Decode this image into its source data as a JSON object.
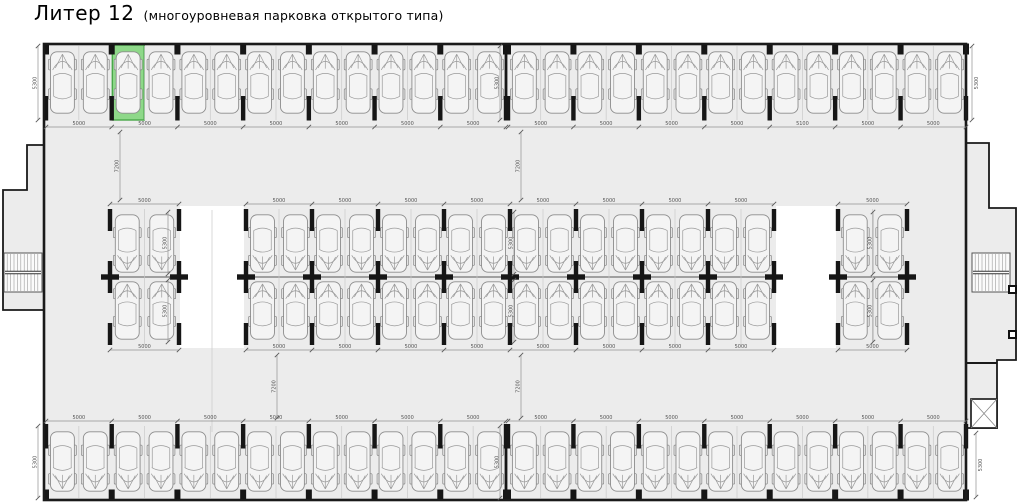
{
  "title": {
    "main": "Литер 12",
    "sub": "(многоуровневая парковка открытого типа)"
  },
  "dimensions": {
    "stall_width": "5000",
    "stall_width_alt": "5100",
    "stall_depth": "5300",
    "aisle_depth": "7200"
  },
  "structure": {
    "top_row": {
      "sections_pairs": [
        7,
        7
      ],
      "alt_dim_section": 2,
      "alt_dim_pair": 5,
      "cars": 28
    },
    "middle_band": {
      "blocks_pairs": [
        1,
        8,
        1
      ],
      "rows": 2,
      "cars": 40
    },
    "bottom_row": {
      "sections_pairs": [
        7,
        7
      ],
      "cars": 28
    },
    "total_parking_spaces": 96
  },
  "highlight": {
    "row": "top",
    "section": 1,
    "pair": 2,
    "stall": 1
  },
  "colors": {
    "background": "#ffffff",
    "floor": "#ececec",
    "wall": "#1a1a1a",
    "car_stroke": "#8d8d8d",
    "dim_text": "#555555",
    "highlight_fill": "#8ed889",
    "highlight_stroke": "#4aa84a"
  }
}
